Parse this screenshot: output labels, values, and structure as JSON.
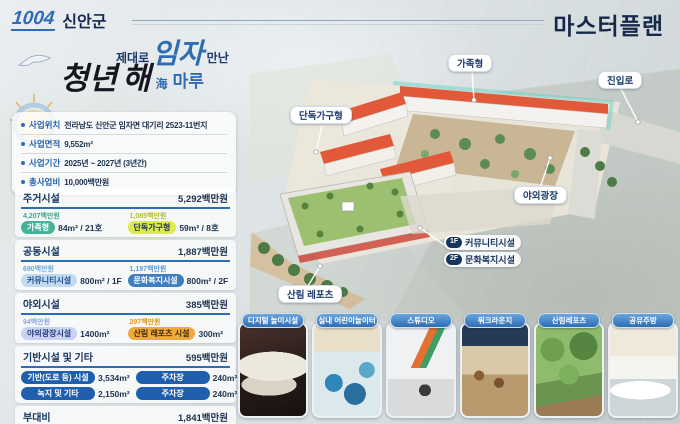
{
  "header": {
    "logo_number": "1004",
    "logo_name": "신안군",
    "title": "마스터플랜"
  },
  "slogan": {
    "small1": "제대로",
    "big1": "임자",
    "small2": "만난",
    "big2": "청년",
    "big3": "해",
    "suffix_hanja": "海",
    "suffix": "마루"
  },
  "project_info": {
    "items": [
      {
        "label": "사업위치",
        "value": "전라남도 신안군 임자면 대기리 2523-11번지"
      },
      {
        "label": "사업면적",
        "value": "9,552m²"
      },
      {
        "label": "사업기간",
        "value": "2025년 ~ 2027년 (3년간)"
      },
      {
        "label": "총사업비",
        "value": "10,000백만원"
      }
    ]
  },
  "costs": {
    "sections": [
      {
        "title": "주거시설",
        "total": "5,292백만원",
        "items": [
          {
            "cost": "4,207백만원",
            "pill": "가족형",
            "value": "84m² / 21호"
          },
          {
            "cost": "1,085백만원",
            "pill": "단독가구형",
            "value": "59m² / 8호"
          }
        ]
      },
      {
        "title": "공동시설",
        "total": "1,887백만원",
        "items": [
          {
            "cost": "690백만원",
            "pill": "커뮤니티시설",
            "value": "800m² / 1F"
          },
          {
            "cost": "1,197백만원",
            "pill": "문화복지시설",
            "value": "800m² / 2F"
          }
        ]
      },
      {
        "title": "야외시설",
        "total": "385백만원",
        "items": [
          {
            "cost": "94백만원",
            "pill": "야외광장시설",
            "value": "1400m²"
          },
          {
            "cost": "297백만원",
            "pill": "산림 레포츠 시설",
            "value": "300m²"
          }
        ]
      },
      {
        "title": "기반시설 및 기타",
        "total": "595백만원",
        "items": [
          {
            "pill": "기반(도로 등) 시설",
            "value": "3,534m²"
          },
          {
            "pill": "주차장",
            "value": "240m²"
          },
          {
            "pill": "녹지 및 기타",
            "value": "2,150m²"
          },
          {
            "pill": "주차장",
            "value": "240m²"
          }
        ]
      },
      {
        "title": "부대비",
        "total": "1,841백만원",
        "items": []
      }
    ]
  },
  "map": {
    "labels": [
      {
        "text": "가족형"
      },
      {
        "text": "진입로"
      },
      {
        "text": "단독가구형"
      },
      {
        "text": "야외광장"
      },
      {
        "text": "산림 레포츠"
      }
    ],
    "legend": [
      {
        "badge": "1F",
        "text": "커뮤니티시설"
      },
      {
        "badge": "2F",
        "text": "문화복지시설"
      }
    ]
  },
  "photos": [
    {
      "title": "디지털 놀이시설"
    },
    {
      "title": "실내 어린이놀이터"
    },
    {
      "title": "스튜디오"
    },
    {
      "title": "워크라운지"
    },
    {
      "title": "산림레포츠"
    },
    {
      "title": "공유주방"
    }
  ],
  "colors": {
    "accent_blue": "#2e6db4",
    "navy": "#16355e",
    "teal": "#45b39a",
    "lime": "#dcea4f",
    "light_blue": "#c2dbf2",
    "blue": "#3f7fc1",
    "lavender": "#c9d2f2",
    "orange": "#f2a93b",
    "dark_blue_pill": "#1f5fae",
    "roof_red": "#e0593a"
  }
}
